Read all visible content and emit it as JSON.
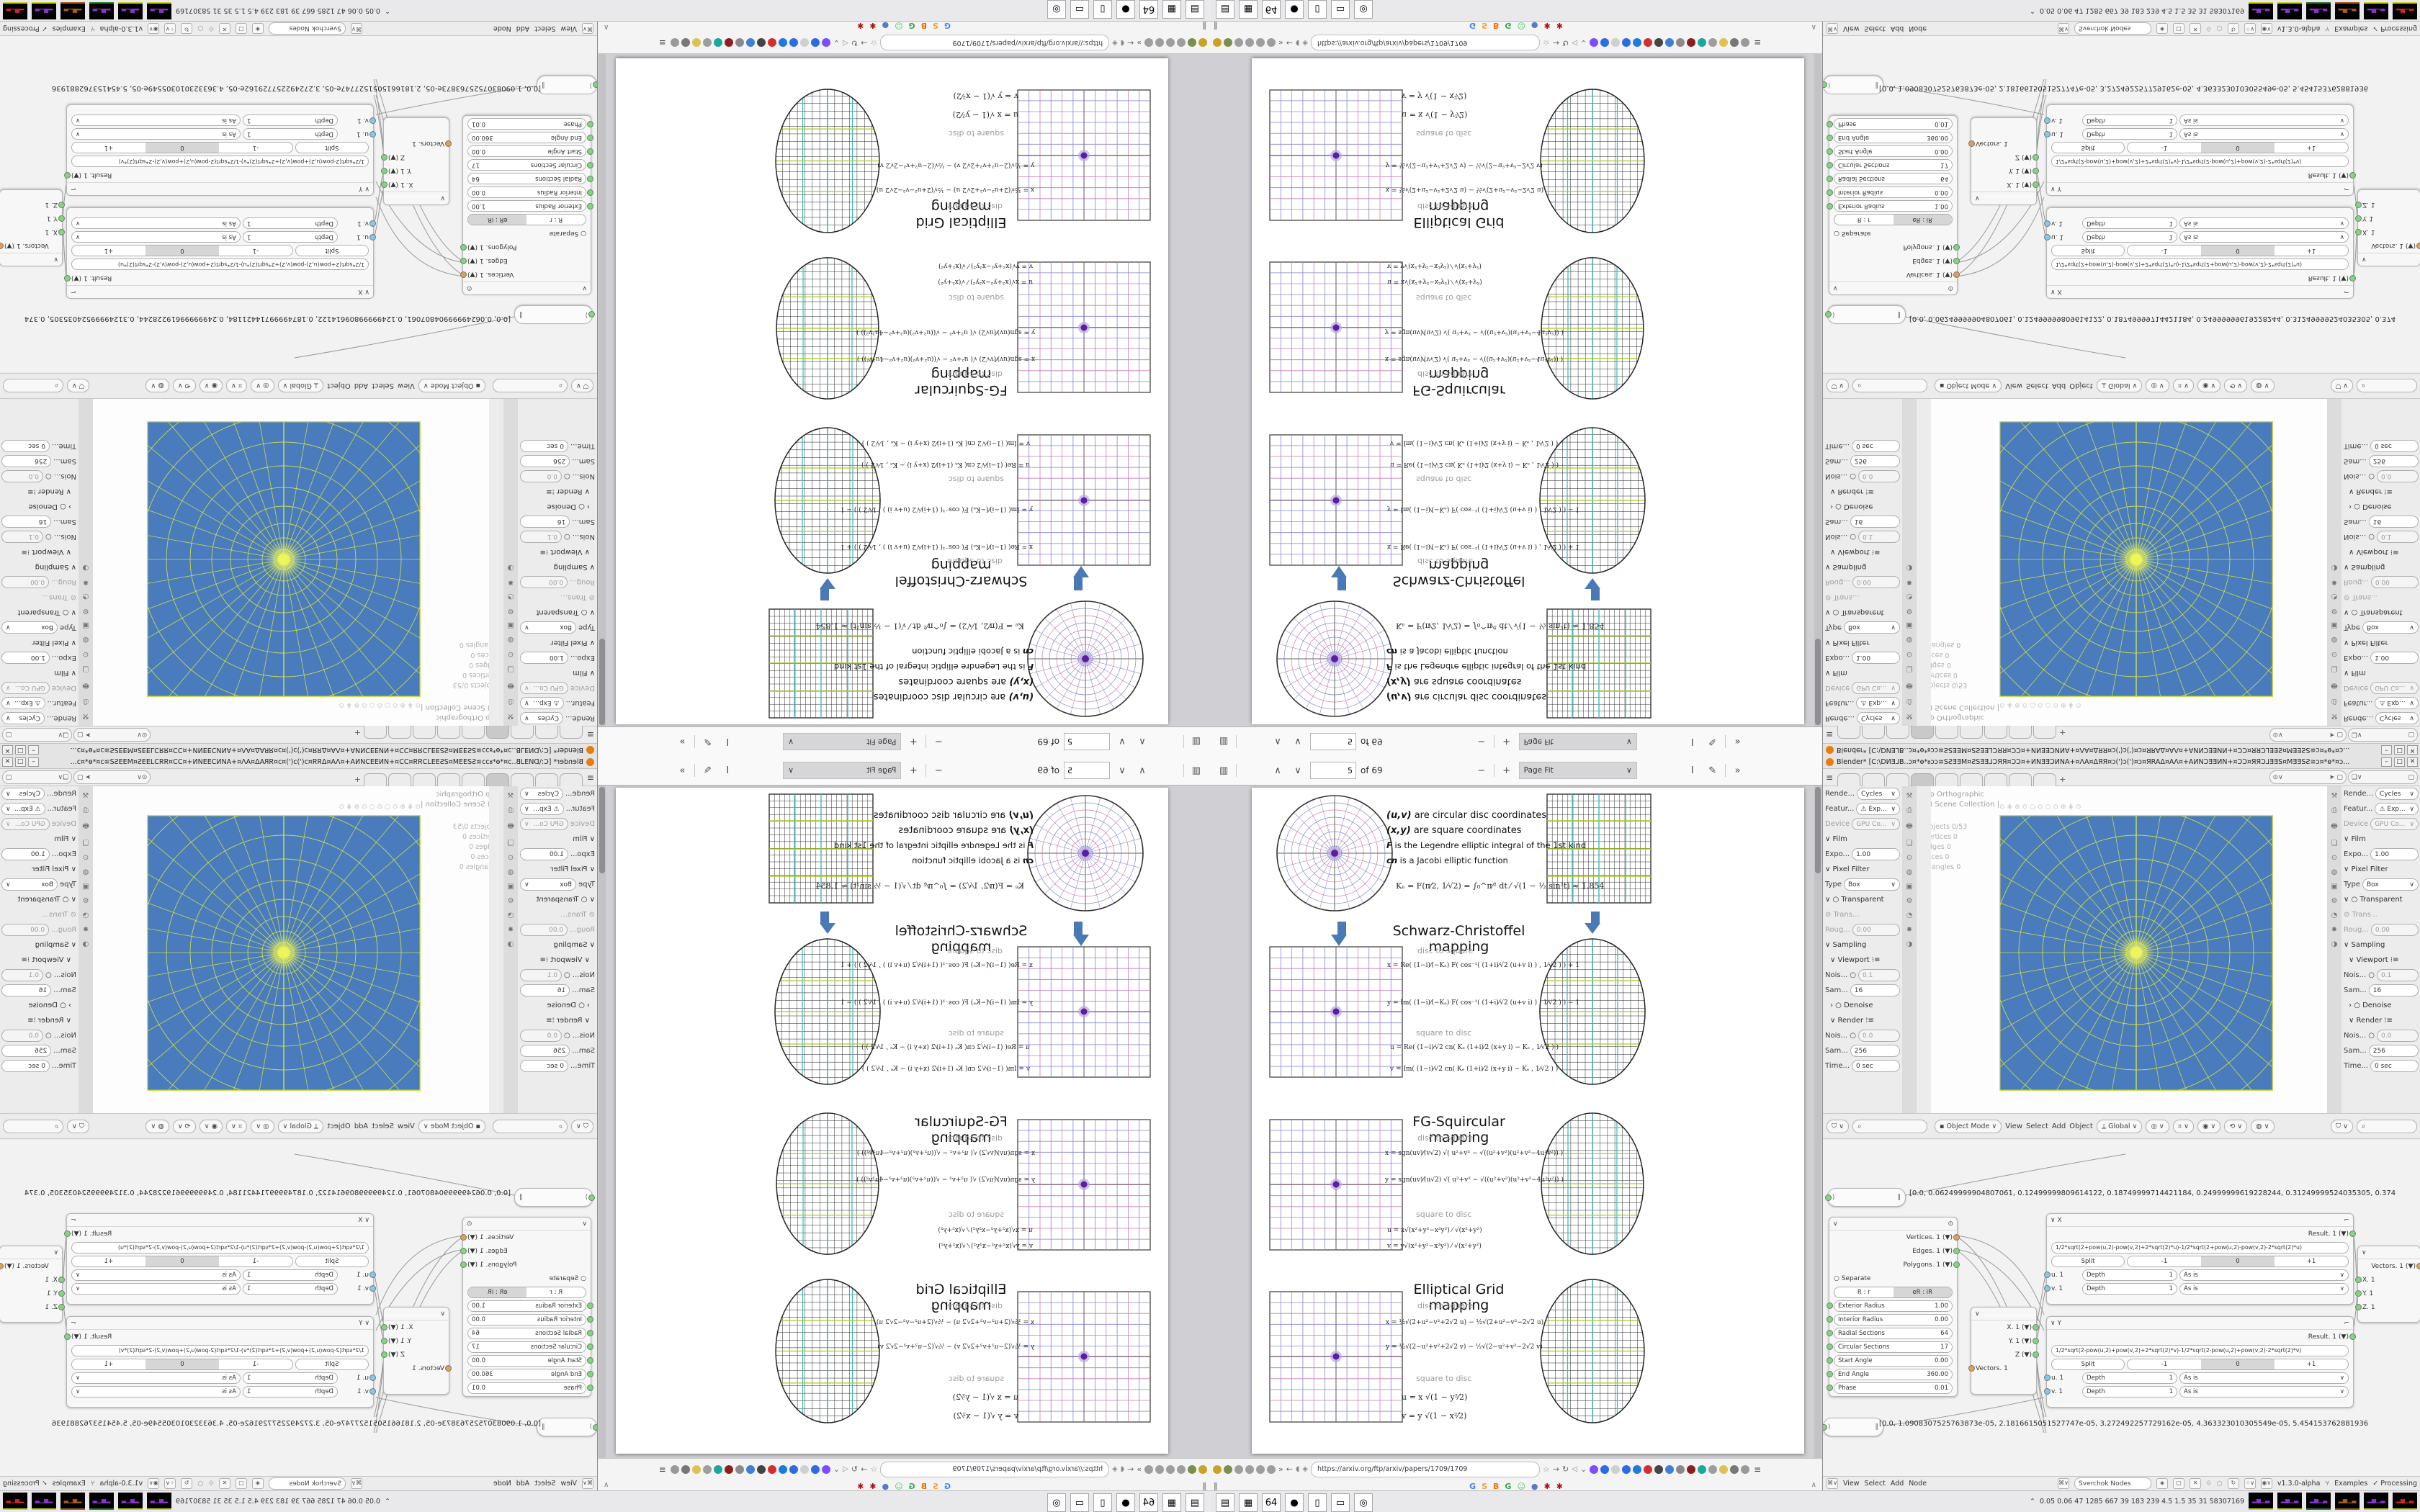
{
  "colors": {
    "viewport_blue": "#4a7bbd",
    "grid_yellow": "#cfe046",
    "grid_bright": "#eef55a",
    "accent_arrow": "#4a7ab5",
    "teal_line": "#3cbcbc",
    "green_line": "#a8cc22",
    "disc_blue": "#8383d6",
    "disc_magenta": "#cc7ab0",
    "disc_center": "#5a1fa0"
  },
  "browser": {
    "toolbar": {
      "page_current": "5",
      "pages_label": "of 69",
      "zoom_label": "Page Fit",
      "sidebar_icon": "▥",
      "prev_icon": "∧",
      "next_icon": "∨",
      "minus_icon": "−",
      "plus_icon": "+",
      "select_icon": "I",
      "draw_icon": "✎",
      "more_icon": "»",
      "chev": "∨"
    },
    "url": "https://arxiv.org/ftp/arxiv/papers/1709/1709",
    "url_icons": {
      "back_icon": "←",
      "fwd_icon": "→",
      "reload_icon": "↻",
      "shield_icon": "◖",
      "lock_icon": "◈",
      "star_icon": "☆",
      "speaker_icon": "◁",
      "down_icon": "⌄",
      "menu_icon": "≡",
      "more_icon": "»"
    },
    "ext_left": [
      "#c9a227",
      "#7a8f4d",
      "#9e9e9e",
      "#9e9e9e",
      "#9e9e9e",
      "#9e9e9e"
    ],
    "ext_right": [
      "#7c4dff",
      "#2d6ae3",
      "#cfcfd2",
      "#2b6be4",
      "#1f7ae0",
      "#d32f2f",
      "#444444",
      "#3f7fd4",
      "#8a8a8e",
      "#8e1f1f",
      "#18a999",
      "#9e9e9e",
      "#e0c14f",
      "#777777",
      "#999999"
    ],
    "bookmarks": [
      {
        "label": "G",
        "style": "color:#4285f4"
      },
      {
        "label": "S",
        "style": "color:#f2a33c"
      },
      {
        "label": "B",
        "style": "color:#e8710a"
      },
      {
        "label": "G",
        "style": "color:#34a853"
      },
      {
        "label": "☺",
        "style": "color:#42c75a"
      },
      {
        "label": "●",
        "style": "color:#5b79c9"
      },
      {
        "label": "✱",
        "style": "color:#b00c0c"
      },
      {
        "label": "✱",
        "style": "color:#b00c0c"
      }
    ],
    "bm_handle": "‖",
    "bm_up": "∧"
  },
  "pdf": {
    "info": {
      "l1b": "(u,v)",
      "l1": " are circular disc coordinates",
      "l2b": "(x,y)",
      "l2": " are square coordinates",
      "l3b": "F",
      "l3": " is the Legendre elliptic integral of the 1st kind",
      "l4b": "cn",
      "l4": " is a Jacobi elliptic function",
      "ke": "Kₑ = F(π⁄2, 1⁄√2) = ∫₀^π⁄² dt ⁄ √(1 − ½ sin²t)  ≈ 1.854"
    },
    "sections": [
      {
        "title": "Schwarz-Christoffel mapping",
        "d2s": "disc to square",
        "s2d": "square to disc",
        "f1": "x = Re( (1−i)⁄(−Kₑ) F( cos⁻¹( (1+i)⁄√2 (u+v i) ) , 1⁄√2 ) ) + 1",
        "f2": "y = Im( (1−i)⁄(−Kₑ) F( cos⁻¹( (1+i)⁄√2 (u+v i) ) , 1⁄√2 ) ) − 1",
        "f3": "u = Re( (1−i)⁄√2  cn( Kₑ (1+i)⁄2 (x+y i) − Kₑ , 1⁄√2 ) )",
        "f4": "v = Im( (1−i)⁄√2  cn( Kₑ (1+i)⁄2 (x+y i) − Kₑ , 1⁄√2 ) )"
      },
      {
        "title": "FG-Squircular mapping",
        "d2s": "disc to square",
        "s2d": "square to disc",
        "f1": "x = sgn(uv)⁄(v√2) √( u²+v² − √((u²+v²)(u²+v²−4u²v²)) )",
        "f2": "y = sgn(uv)⁄(u√2) √( u²+v² − √((u²+v²)(u²+v²−4u²v²)) )",
        "f3": "u = x√(x²+y²−x²y²) ⁄ √(x²+y²)",
        "f4": "v = y√(x²+y²−x²y²) ⁄ √(x²+y²)"
      },
      {
        "title": "Elliptical Grid mapping",
        "d2s": "disc to square",
        "s2d": "square to disc",
        "f1": "x = ½√(2+u²−v²+2√2 u)  −  ½√(2+u²−v²−2√2 u)",
        "f2": "y = ½√(2−u²+v²+2√2 v)  −  ½√(2−u²+v²−2√2 v)",
        "f3": "u = x √(1 − y²⁄2)",
        "f4": "v = y √(1 − x²⁄2)"
      }
    ]
  },
  "blender": {
    "title": "Blender* [C:\\DИƎ⅃B..ɔ¤*ɵ*ᴕɔɔ≅SƧƎƎM¤ƧSƎƎ⅃ƆЯЯ¤ƆƆ¤+ИΝƎƎƆͶNA+¤ɅA¤ΔЯЯ¤ɔ(')ɔ(')¤ɔ¤ЯRAΔ¤AɅ¤+AͶNƆƎƎͶN+¤ƆƆ¤ЯЯƆ⅃ƎƎS¤MƎƎSƧ≅ɔ¤*ɵ*¤ɔ...",
    "win_min": "–",
    "win_max": "□",
    "win_close": "✕",
    "topbar": {
      "hamburger": "≡",
      "new_tab": "+"
    },
    "props": {
      "render_l": "Rende...",
      "render_v": "Cycles",
      "feature_l": "Featur...",
      "feature_v": "⚠ Exp...",
      "device_l": "Device",
      "device_v": "GPU Co...",
      "film": "∨ Film",
      "expo_l": "Expo...",
      "expo_v": "1.00",
      "pixel_filter": "∨ Pixel Filter",
      "type_l": "Type",
      "type_v": "Box",
      "transparent": "∨ ○ Transparent",
      "trans": "⊘ Trans...",
      "roug_l": "Roug...",
      "roug_v": "0.00",
      "sampling": "∨ Sampling",
      "viewport": "∨ Viewport  ⁝≡",
      "nois_vp_l": "Nois... ○",
      "nois_vp_v": "0.1",
      "sam_vp_l": "Sam...",
      "sam_vp_v": "16",
      "denoise": "› ○ Denoise",
      "render": "∨ Render  ⁝≡",
      "nois_r_l": "Nois... ○",
      "nois_r_v": "0.0",
      "sam_r_l": "Sam...",
      "sam_r_v": "256",
      "time_l": "Time...",
      "time_v": "0 sec"
    },
    "viewport": {
      "axis": "Top Orthographic",
      "collection": "(2) Scene Collection |",
      "icons": "⊙⋕⊕⊙○⊙○⊙⊕⋕⊙",
      "s1": "Objects   0/53",
      "s2": "Vertices   0",
      "s3": "Edges   0",
      "s4": "Faces   0",
      "s5": "Triangles   0"
    },
    "hdr3d": {
      "mode": "▪ Object Mode",
      "m1": "View",
      "m2": "Select",
      "m3": "Add",
      "m4": "Object",
      "orient": "⟂ Global"
    },
    "nodes": {
      "float1": "[0.0, 1.0908307525763873e-05, 2.1816615051527747e-05, 3.272492257729162e-05, 4.363323010305549e-05, 5.454153762881936",
      "float2": "[0.0, 0.06249999904807061, 0.12499999809614122, 0.18749999714421184, 0.24999999619228244, 0.31249999524035305, 0.374",
      "ring": {
        "o1": "Vertices. 1",
        "o2": "Edges. 1",
        "o3": "Polygons. 1",
        "sep": "○ Separate",
        "b1": "R : r",
        "b2": "eR : iR",
        "p1l": "Exterior Radius",
        "p1v": "1.00",
        "p2l": "Interior Radius",
        "p2v": "0.00",
        "p3l": "Radial Sections",
        "p3v": "64",
        "p4l": "Circular Sections",
        "p4v": "17",
        "p5l": "Start Angle",
        "p5v": "0.00",
        "p6l": "End Angle",
        "p6v": "360.00",
        "p7l": "Phase",
        "p7v": "0.01"
      },
      "vecout": {
        "o1": "X. 1",
        "o2": "Y. 1",
        "o3": "Z",
        "in": "Vectors. 1"
      },
      "xnode": {
        "name": "∨ X",
        "tool": "⌐",
        "result": "Result. 1",
        "formula": "1/2*sqrt(2+pow(u,2)-pow(v,2)+2*sqrt(2)*u)-1/2*sqrt(2+pow(u,2)-pow(v,2)-2*sqrt(2)*u)",
        "split": "Split",
        "m1": "-1",
        "m2": "0",
        "m3": "+1",
        "u": "u. 1",
        "v": "v. 1",
        "depth": "Depth",
        "dv": "1",
        "asis": "As is"
      },
      "ynode": {
        "name": "∨ Y",
        "tool": "⌐",
        "result": "Result. 1",
        "formula": "1/2*sqrt(2-pow(u,2)+pow(v,2)+2*sqrt(2)*v)-1/2*sqrt(2-pow(u,2)+pow(v,2)-2*sqrt(2)*v)",
        "split": "Split",
        "m1": "-1",
        "m2": "0",
        "m3": "+1",
        "u": "u. 1",
        "v": "v. 1",
        "depth": "Depth",
        "dv": "1",
        "asis": "As is"
      },
      "vecin": {
        "out": "Vectors. 1",
        "i1": "X. 1",
        "i2": "Y. 1",
        "i3": "Z. 1"
      }
    },
    "nfooter": {
      "m1": "View",
      "m2": "Select",
      "m3": "Add",
      "m4": "Node",
      "search": "Sverchok Nodes",
      "version": "v1.3.0-alpha",
      "examples": "Examples",
      "processing": "✓  Processing",
      "shuffle": "⑂"
    },
    "monitor": {
      "up": "⌃",
      "nums": "0.05 0.06   47   1285 667   39   183 239   4.5   1.5   35   31   58307169",
      "g": "▂▅▁▃"
    }
  },
  "taskbar_apps": [
    {
      "glyph": "▤",
      "style": "color:#23408e"
    },
    {
      "glyph": "▦",
      "style": "color:#2e7d32"
    },
    {
      "glyph": "64",
      "style": "color:#555;font-size:8px"
    },
    {
      "glyph": "●",
      "style": "color:#e8710a"
    },
    {
      "glyph": "▯",
      "style": "color:#8a8a8e"
    },
    {
      "glyph": "▭",
      "style": "color:#3b6bd6"
    },
    {
      "glyph": "◎",
      "style": "color:#e87d0d"
    }
  ]
}
